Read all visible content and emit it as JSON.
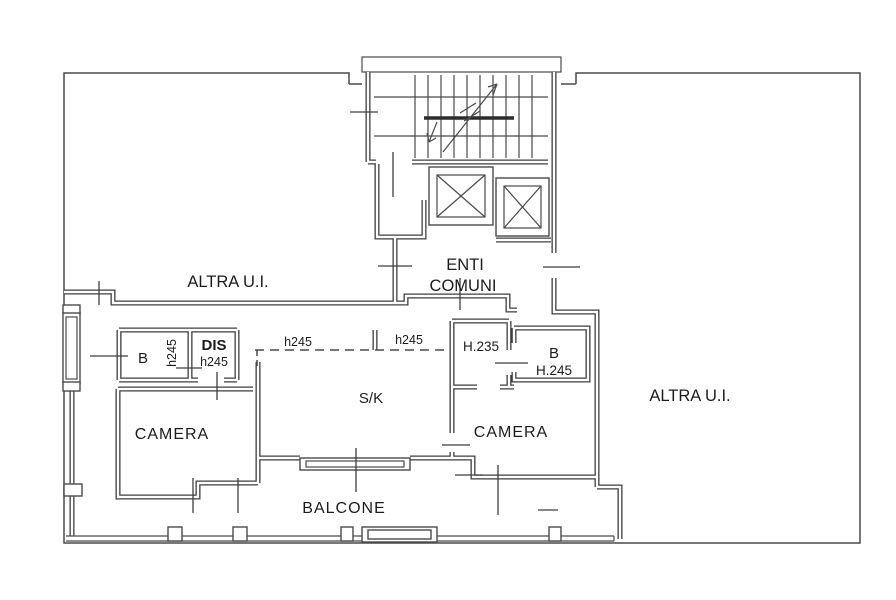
{
  "drawing": {
    "type": "floor-plan",
    "labels": {
      "altra_ui_left": "ALTRA U.I.",
      "altra_ui_right": "ALTRA U.I.",
      "enti": "ENTI",
      "comuni": "COMUNI",
      "bath_left": "B",
      "bath_left_height": "h245",
      "dis": "DIS",
      "dis_height": "h245",
      "sk": "S/K",
      "sk_height_left": "h245",
      "sk_height_right": "h245",
      "corridor_height": "H.235",
      "bath_right": "B",
      "bath_right_height": "H.245",
      "camera_left": "CAMERA",
      "camera_right": "CAMERA",
      "balcone": "BALCONE"
    },
    "colors": {
      "line": "#3d3d3d",
      "text": "#1c1c1c",
      "background": "#ffffff"
    }
  }
}
